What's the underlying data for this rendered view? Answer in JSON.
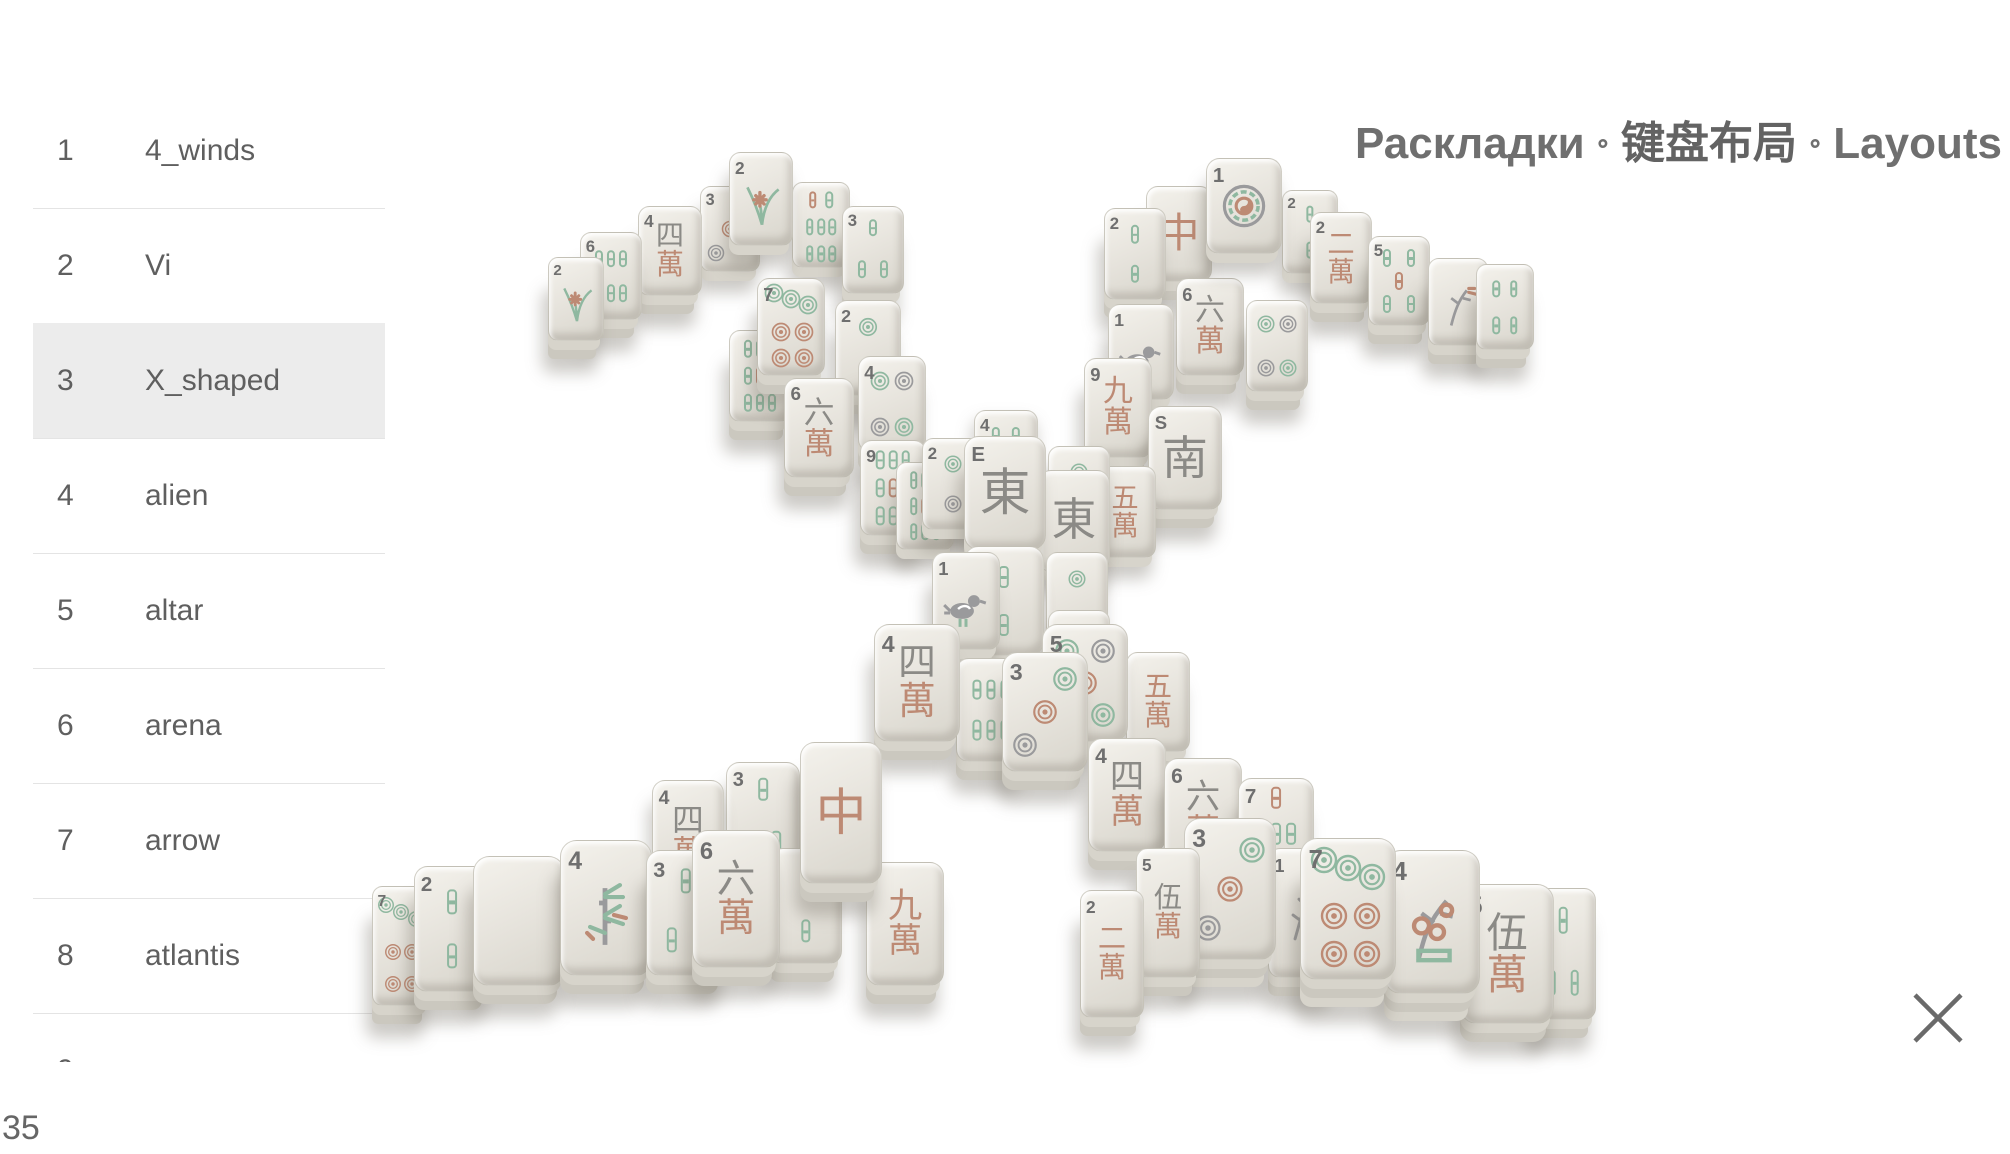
{
  "title": {
    "ru": "Раскладки",
    "zh": "键盘布局",
    "en": "Layouts",
    "separator": "∘"
  },
  "sidebar": {
    "selected": "X_shaped",
    "selected_index": 2,
    "items": [
      {
        "n": "1",
        "label": "4_winds"
      },
      {
        "n": "2",
        "label": "Vi"
      },
      {
        "n": "3",
        "label": "X_shaped"
      },
      {
        "n": "4",
        "label": "alien"
      },
      {
        "n": "5",
        "label": "altar"
      },
      {
        "n": "6",
        "label": "arena"
      },
      {
        "n": "7",
        "label": "arrow"
      },
      {
        "n": "8",
        "label": "atlantis"
      },
      {
        "n": "9",
        "label": ""
      }
    ]
  },
  "footer": {
    "count": "35"
  },
  "close": {
    "icon": "close-x"
  },
  "colors": {
    "green": "#8fb8a0",
    "red": "#bd8a74",
    "gray": "#9a9a9c",
    "charcoal": "#8b8a86",
    "num": "#6f6f6f",
    "face_light": "#f4f2ec",
    "face_dark": "#d8d5cc",
    "stack1": "#d7d4cb",
    "stack2": "#cbc8bf",
    "highlight": "#ececec",
    "divider": "#e4e4e4",
    "text": "#5f5f5f",
    "title": "#6f6f6f"
  },
  "board": {
    "name": "X_shaped layout preview",
    "tiles": [
      {
        "x": 548,
        "y": 257,
        "w": 56,
        "h": 84,
        "n": "2",
        "t": "flower",
        "v": "orchid",
        "s": 2
      },
      {
        "x": 580,
        "y": 232,
        "w": 62,
        "h": 88,
        "n": "6",
        "t": "bamboo",
        "v": 6,
        "s": 2
      },
      {
        "x": 638,
        "y": 206,
        "w": 64,
        "h": 90,
        "n": "4",
        "t": "man",
        "c": [
          [
            "四",
            "gray"
          ],
          [
            "萬",
            "red"
          ]
        ],
        "s": 2
      },
      {
        "x": 700,
        "y": 186,
        "w": 60,
        "h": 86,
        "n": "3",
        "t": "dots",
        "v": 3,
        "s": 1
      },
      {
        "x": 792,
        "y": 182,
        "w": 58,
        "h": 86,
        "n": "",
        "t": "bamboo",
        "v": 8,
        "s": 1
      },
      {
        "x": 729,
        "y": 152,
        "w": 64,
        "h": 94,
        "n": "2",
        "t": "flower",
        "v": "orchid",
        "s": 1,
        "z": 400
      },
      {
        "x": 842,
        "y": 206,
        "w": 62,
        "h": 88,
        "n": "3",
        "t": "bamboo",
        "v": 3,
        "s": 2
      },
      {
        "x": 757,
        "y": 278,
        "w": 68,
        "h": 98,
        "n": "7",
        "t": "dots",
        "v": 7,
        "s": 2,
        "z": 360
      },
      {
        "x": 835,
        "y": 300,
        "w": 66,
        "h": 96,
        "n": "2",
        "t": "dots",
        "v": 2,
        "s": 2,
        "z": 340
      },
      {
        "x": 729,
        "y": 330,
        "w": 62,
        "h": 92,
        "n": "",
        "t": "bamboo",
        "v": 9,
        "s": 2,
        "z": 345
      },
      {
        "x": 784,
        "y": 378,
        "w": 70,
        "h": 100,
        "n": "6",
        "t": "man",
        "c": [
          [
            "六",
            "gray"
          ],
          [
            "萬",
            "red"
          ]
        ],
        "s": 2,
        "z": 420
      },
      {
        "x": 858,
        "y": 356,
        "w": 68,
        "h": 96,
        "n": "4",
        "t": "dots",
        "v": 4,
        "s": 2,
        "z": 380
      },
      {
        "x": 860,
        "y": 440,
        "w": 66,
        "h": 96,
        "n": "9",
        "t": "bamboo",
        "v": 9,
        "s": 2,
        "z": 450
      },
      {
        "x": 926,
        "y": 442,
        "w": 58,
        "h": 88,
        "n": "2",
        "t": "dots",
        "v": 2,
        "s": 1,
        "z": 445
      },
      {
        "x": 1146,
        "y": 186,
        "w": 66,
        "h": 96,
        "n": "",
        "t": "dragon",
        "c": [
          [
            "中",
            "red"
          ]
        ],
        "s": 2
      },
      {
        "x": 1206,
        "y": 158,
        "w": 76,
        "h": 96,
        "n": "1",
        "t": "dots",
        "v": 1,
        "s": 1,
        "z": 410
      },
      {
        "x": 1282,
        "y": 190,
        "w": 56,
        "h": 84,
        "n": "2",
        "t": "bamboo",
        "v": 2,
        "s": 1
      },
      {
        "x": 1104,
        "y": 208,
        "w": 62,
        "h": 92,
        "n": "2",
        "t": "bamboo",
        "v": 2,
        "s": 2
      },
      {
        "x": 1310,
        "y": 212,
        "w": 62,
        "h": 92,
        "n": "2",
        "t": "man",
        "c": [
          [
            "二",
            "red"
          ],
          [
            "萬",
            "red"
          ]
        ],
        "s": 2
      },
      {
        "x": 1368,
        "y": 236,
        "w": 62,
        "h": 90,
        "n": "5",
        "t": "bamboo",
        "v": 5,
        "s": 2
      },
      {
        "x": 1428,
        "y": 258,
        "w": 60,
        "h": 88,
        "n": "",
        "t": "flower",
        "v": "autumn",
        "s": 2
      },
      {
        "x": 1476,
        "y": 264,
        "w": 58,
        "h": 86,
        "n": "",
        "t": "bamboo",
        "v": 4,
        "s": 2
      },
      {
        "x": 1108,
        "y": 304,
        "w": 66,
        "h": 96,
        "n": "1",
        "t": "bird",
        "s": 2,
        "z": 380
      },
      {
        "x": 1176,
        "y": 278,
        "w": 68,
        "h": 98,
        "n": "6",
        "t": "man",
        "c": [
          [
            "六",
            "gray"
          ],
          [
            "萬",
            "red"
          ]
        ],
        "s": 2
      },
      {
        "x": 1246,
        "y": 300,
        "w": 62,
        "h": 92,
        "n": "",
        "t": "dots",
        "v": 4,
        "s": 2
      },
      {
        "x": 1084,
        "y": 358,
        "w": 68,
        "h": 100,
        "n": "9",
        "t": "man",
        "c": [
          [
            "九",
            "red"
          ],
          [
            "萬",
            "red"
          ]
        ],
        "s": 2,
        "z": 400
      },
      {
        "x": 1148,
        "y": 406,
        "w": 74,
        "h": 104,
        "n": "",
        "t": "wind",
        "c": [
          [
            "南",
            "gray"
          ]
        ],
        "L": "S",
        "s": 2,
        "z": 430
      },
      {
        "x": 974,
        "y": 410,
        "w": 64,
        "h": 90,
        "n": "4",
        "t": "bamboo",
        "v": 4,
        "s": 0
      },
      {
        "x": 922,
        "y": 438,
        "w": 62,
        "h": 92,
        "n": "2",
        "t": "dots",
        "v": 2,
        "s": 1,
        "z": 500
      },
      {
        "x": 896,
        "y": 462,
        "w": 58,
        "h": 88,
        "n": "",
        "t": "bamboo",
        "v": 9,
        "s": 1,
        "z": 470
      },
      {
        "x": 1048,
        "y": 446,
        "w": 62,
        "h": 92,
        "n": "",
        "t": "dots",
        "v": 2,
        "s": 1,
        "z": 505
      },
      {
        "x": 1094,
        "y": 466,
        "w": 62,
        "h": 92,
        "n": "",
        "t": "man",
        "c": [
          [
            "五",
            "red"
          ],
          [
            "萬",
            "red"
          ]
        ],
        "s": 1,
        "z": 460
      },
      {
        "x": 1038,
        "y": 470,
        "w": 72,
        "h": 102,
        "n": "",
        "t": "wind",
        "c": [
          [
            "東",
            "gray"
          ]
        ],
        "L": "",
        "s": 1,
        "z": 520
      },
      {
        "x": 964,
        "y": 436,
        "w": 82,
        "h": 114,
        "n": "",
        "t": "wind",
        "c": [
          [
            "東",
            "gray"
          ]
        ],
        "L": "E",
        "s": 2,
        "z": 600
      },
      {
        "x": 964,
        "y": 546,
        "w": 80,
        "h": 110,
        "n": "",
        "t": "bamboo",
        "v": 2,
        "s": 2,
        "z": 610
      },
      {
        "x": 1046,
        "y": 552,
        "w": 62,
        "h": 96,
        "n": "",
        "t": "dots",
        "v": 2,
        "s": 1,
        "z": 605
      },
      {
        "x": 1048,
        "y": 610,
        "w": 62,
        "h": 92,
        "n": "",
        "t": "dots",
        "v": 2,
        "s": 1,
        "z": 607
      },
      {
        "x": 932,
        "y": 552,
        "w": 68,
        "h": 98,
        "n": "1",
        "t": "bird",
        "s": 2,
        "z": 615
      },
      {
        "x": 874,
        "y": 624,
        "w": 86,
        "h": 118,
        "n": "4",
        "t": "man",
        "c": [
          [
            "四",
            "gray"
          ],
          [
            "萬",
            "red"
          ]
        ],
        "s": 2,
        "z": 640
      },
      {
        "x": 956,
        "y": 658,
        "w": 70,
        "h": 104,
        "n": "",
        "t": "bamboo",
        "v": 6,
        "s": 2,
        "z": 635
      },
      {
        "x": 1002,
        "y": 652,
        "w": 86,
        "h": 120,
        "n": "3",
        "t": "dots",
        "v": 3,
        "s": 2,
        "z": 650
      },
      {
        "x": 1042,
        "y": 624,
        "w": 86,
        "h": 118,
        "n": "5",
        "t": "dots",
        "v": 5,
        "s": 2,
        "z": 645
      },
      {
        "x": 1126,
        "y": 652,
        "w": 64,
        "h": 100,
        "n": "",
        "t": "man",
        "c": [
          [
            "五",
            "red"
          ],
          [
            "萬",
            "red"
          ]
        ],
        "s": 2,
        "z": 630
      },
      {
        "x": 372,
        "y": 886,
        "w": 58,
        "h": 120,
        "n": "7",
        "t": "dots",
        "v": 7,
        "s": 2,
        "z": 860
      },
      {
        "x": 414,
        "y": 866,
        "w": 76,
        "h": 126,
        "n": "2",
        "t": "bamboo",
        "v": 2,
        "s": 2,
        "z": 870
      },
      {
        "x": 473,
        "y": 856,
        "w": 92,
        "h": 130,
        "n": "",
        "t": "blank",
        "s": 2,
        "z": 880
      },
      {
        "x": 560,
        "y": 840,
        "w": 92,
        "h": 136,
        "n": "4",
        "t": "flower",
        "v": "bamboo",
        "s": 2,
        "z": 890
      },
      {
        "x": 646,
        "y": 850,
        "w": 80,
        "h": 126,
        "n": "3",
        "t": "bamboo",
        "v": 3,
        "s": 2,
        "z": 900
      },
      {
        "x": 652,
        "y": 780,
        "w": 72,
        "h": 112,
        "n": "4",
        "t": "man",
        "c": [
          [
            "四",
            "gray"
          ],
          [
            "萬",
            "red"
          ]
        ],
        "s": 1
      },
      {
        "x": 726,
        "y": 762,
        "w": 74,
        "h": 112,
        "n": "3",
        "t": "bamboo",
        "v": 3,
        "s": 1
      },
      {
        "x": 692,
        "y": 830,
        "w": 88,
        "h": 138,
        "n": "6",
        "t": "man",
        "c": [
          [
            "六",
            "gray"
          ],
          [
            "萬",
            "red"
          ]
        ],
        "s": 2,
        "z": 910
      },
      {
        "x": 770,
        "y": 848,
        "w": 72,
        "h": 116,
        "n": "",
        "t": "bamboo",
        "v": 2,
        "s": 2,
        "z": 905
      },
      {
        "x": 800,
        "y": 742,
        "w": 82,
        "h": 142,
        "n": "",
        "t": "dragon",
        "c": [
          [
            "中",
            "red"
          ]
        ],
        "s": 2,
        "z": 920
      },
      {
        "x": 866,
        "y": 862,
        "w": 78,
        "h": 124,
        "n": "",
        "t": "man",
        "c": [
          [
            "九",
            "red"
          ],
          [
            "萬",
            "red"
          ]
        ],
        "s": 2,
        "z": 915
      },
      {
        "x": 1088,
        "y": 738,
        "w": 78,
        "h": 114,
        "n": "4",
        "t": "man",
        "c": [
          [
            "四",
            "gray"
          ],
          [
            "萬",
            "red"
          ]
        ],
        "s": 2
      },
      {
        "x": 1164,
        "y": 758,
        "w": 78,
        "h": 114,
        "n": "6",
        "t": "man",
        "c": [
          [
            "六",
            "gray"
          ],
          [
            "萬",
            "red"
          ]
        ],
        "s": 2
      },
      {
        "x": 1238,
        "y": 778,
        "w": 76,
        "h": 112,
        "n": "7",
        "t": "bamboo",
        "v": 7,
        "s": 2
      },
      {
        "x": 1080,
        "y": 890,
        "w": 64,
        "h": 128,
        "n": "2",
        "t": "man",
        "c": [
          [
            "二",
            "red"
          ],
          [
            "萬",
            "red"
          ]
        ],
        "s": 2,
        "z": 965
      },
      {
        "x": 1136,
        "y": 848,
        "w": 64,
        "h": 130,
        "n": "5",
        "t": "man",
        "c": [
          [
            "伍",
            "gray"
          ],
          [
            "萬",
            "red"
          ]
        ],
        "s": 2,
        "z": 960
      },
      {
        "x": 1184,
        "y": 818,
        "w": 92,
        "h": 142,
        "n": "3",
        "t": "dots",
        "v": 3,
        "s": 3,
        "z": 955
      },
      {
        "x": 1268,
        "y": 848,
        "w": 68,
        "h": 130,
        "n": "1",
        "t": "branch",
        "s": 2,
        "z": 942
      },
      {
        "x": 1300,
        "y": 838,
        "w": 96,
        "h": 142,
        "n": "7",
        "t": "dots",
        "v": 7,
        "s": 3,
        "z": 945
      },
      {
        "x": 1384,
        "y": 850,
        "w": 96,
        "h": 144,
        "n": "4",
        "t": "flower",
        "v": "plum",
        "s": 3,
        "z": 940
      },
      {
        "x": 1460,
        "y": 884,
        "w": 94,
        "h": 140,
        "n": "5",
        "t": "man",
        "c": [
          [
            "伍",
            "gray"
          ],
          [
            "萬",
            "red"
          ]
        ],
        "s": 2,
        "z": 935
      },
      {
        "x": 1530,
        "y": 888,
        "w": 66,
        "h": 132,
        "n": "",
        "t": "bamboo",
        "v": 3,
        "s": 2,
        "z": 930
      }
    ]
  }
}
